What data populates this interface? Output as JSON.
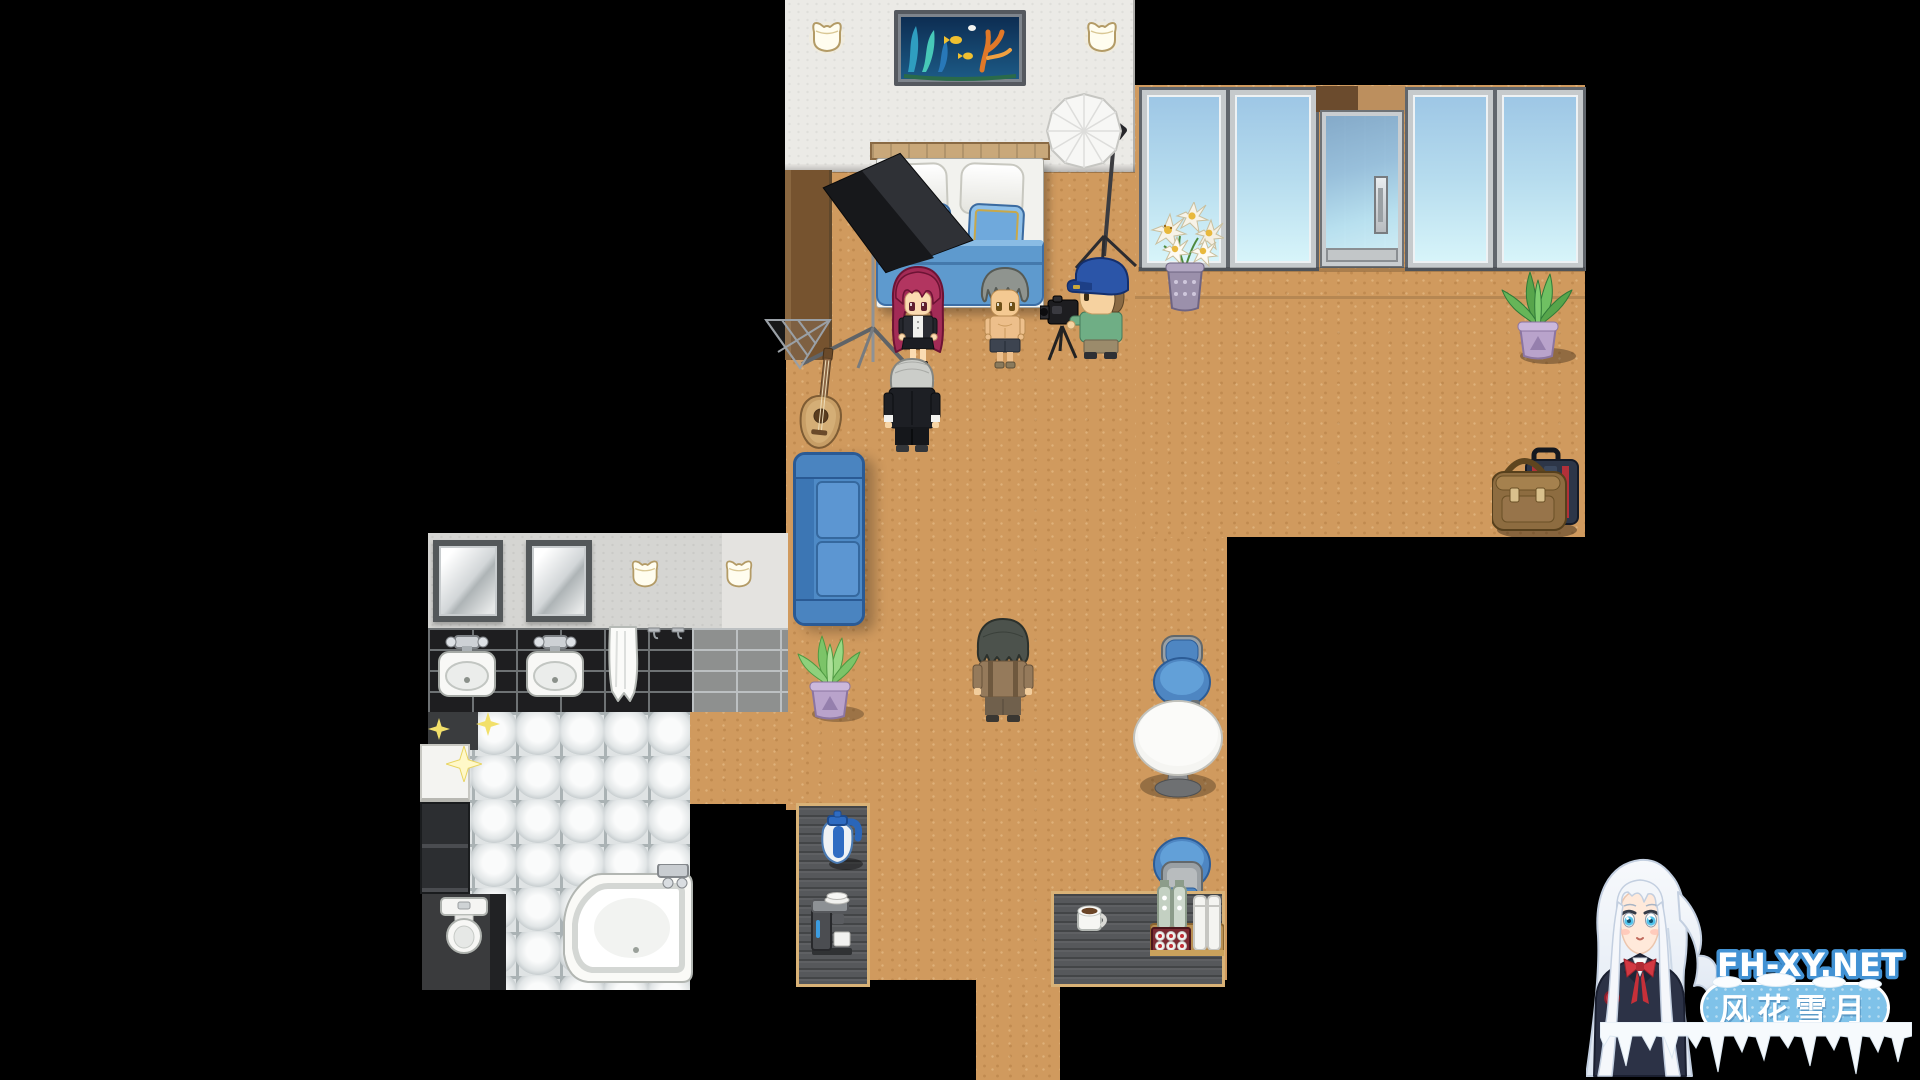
{
  "canvas": {
    "width": 1920,
    "height": 1080,
    "background_color": "#000000"
  },
  "watermark": {
    "site": "FH-XY.NET",
    "banner": "风花雪月",
    "site_text_color": "#ffffff",
    "site_outline_color": "#4292d4",
    "banner_color": "#7fc2e9",
    "banner_border_color": "#ffffff",
    "mascot": "white-haired anime girl in navy school uniform with red ribbon",
    "decoration": "snow and icicles"
  },
  "palette": {
    "floor": "#d09a5e",
    "bedroom_wall": "#ebeae6",
    "side_wall": "#7c5a38",
    "window_glass_top": "#9dc6e5",
    "window_glass_bottom": "#d8f5fa",
    "door_glass": "#8fb8d8",
    "bed_blanket": "#5e9ace",
    "bed_pillow_blue": "#6fa9dc",
    "sofa": "#4e8ac6",
    "chair": "#4e86c2",
    "counter": "#56585b",
    "counter_trim": "#d9b277",
    "bath_wall": "#d5d5d2",
    "bath_black_tile": "#1e1e20",
    "glass_block_tile": "#dfe3e4"
  },
  "scene": {
    "description": "Top-down RPG interior: hotel suite photo-shoot scene with bedroom, window wall with glass door, bathroom, lounge and kitchenette",
    "characters": [
      {
        "id": "red-haired-woman",
        "look": "long magenta hair, black jacket over white shirt, black skirt"
      },
      {
        "id": "gray-haired-shirtless-man",
        "look": "gray hair, bare chest, dark shorts"
      },
      {
        "id": "cameraman",
        "look": "blue baseball cap, green shirt, black camera on tripod"
      },
      {
        "id": "silver-haired-butler",
        "look": "silver combed hair, black suit with white cuffs"
      },
      {
        "id": "dark-haired-man",
        "look": "messy dark hair, brown jacket, seen from behind"
      }
    ],
    "objects": [
      "double-bed",
      "reef-painting",
      "wall-lamps",
      "softbox-studio-light",
      "umbrella-studio-light",
      "glass-door",
      "windows",
      "lily-vase",
      "potted-plant-left",
      "potted-plant-right",
      "blue-sofa",
      "guitar",
      "luggage-suitcase-and-bag",
      "round-table",
      "blue-chairs",
      "kitchen-counter",
      "coffee-machine",
      "blue-kettle",
      "coffee-mug",
      "bottle-tray",
      "bathroom-mirrors",
      "twin-sinks",
      "hand-towel",
      "wall-hooks",
      "corner-bathtub",
      "toilet",
      "vanity-cabinet",
      "glass-block-floor",
      "sparkles"
    ]
  }
}
